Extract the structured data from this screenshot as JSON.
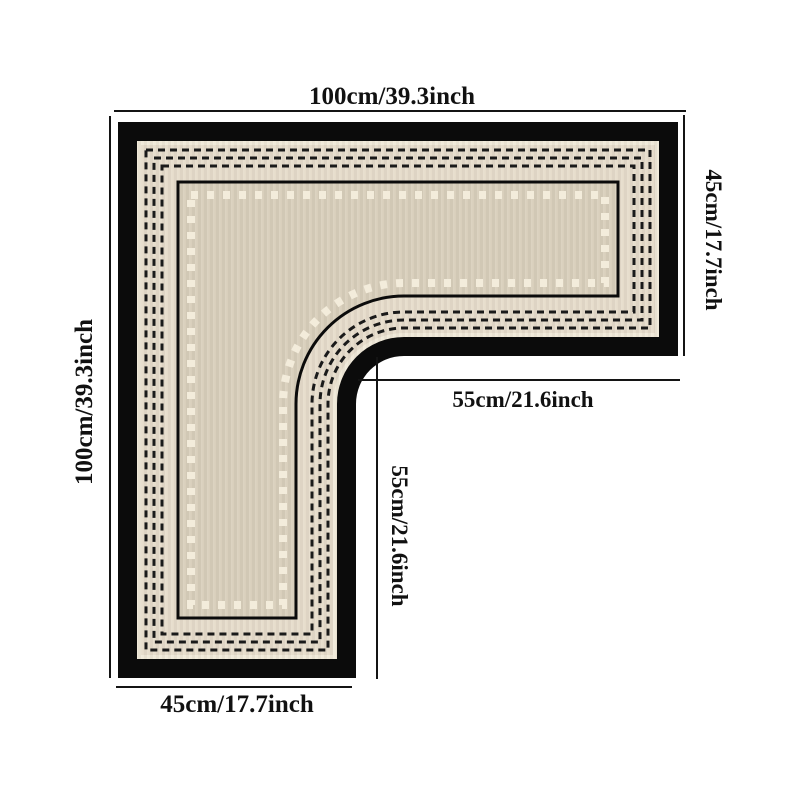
{
  "diagram": {
    "colors": {
      "background": "#ffffff",
      "border": "#0b0b0b",
      "band_edge": "#f0e9d9",
      "band": "#e6dccb",
      "field": "#d9cfbc",
      "dots": "#f3ecdb",
      "stitch": "#1a1a1a",
      "inner_line": "#0b0b0b",
      "dimension_line": "#141414",
      "label_text": "#111111"
    },
    "dimensions": {
      "top_width": {
        "cm": 100,
        "inch": 39.3,
        "label": "100cm/39.3inch"
      },
      "left_height": {
        "cm": 100,
        "inch": 39.3,
        "label": "100cm/39.3inch"
      },
      "right_arm_height": {
        "cm": 45,
        "inch": 17.7,
        "label": "45cm/17.7inch"
      },
      "inner_width": {
        "cm": 55,
        "inch": 21.6,
        "label": "55cm/21.6inch"
      },
      "inner_height": {
        "cm": 55,
        "inch": 21.6,
        "label": "55cm/21.6inch"
      },
      "bottom_leg_width": {
        "cm": 45,
        "inch": 17.7,
        "label": "45cm/17.7inch"
      }
    }
  }
}
